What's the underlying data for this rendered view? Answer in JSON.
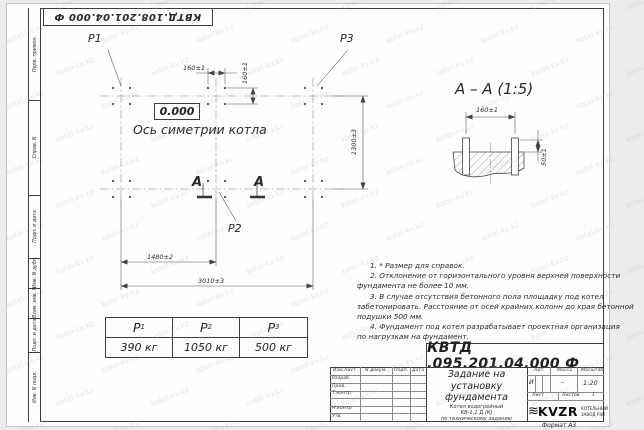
{
  "stamp_top": "КВТД.108.201.04.000 Ф",
  "side_labels": [
    "Перв. примен.",
    "Справ. N",
    "Подп. и дата",
    "Инв. N дубл.",
    "Взам. инв. N",
    "Подп. и дата",
    "Инв. N подл."
  ],
  "plan": {
    "elevation": "0.000",
    "axis_label": "Ось симетрии котла",
    "p1": "P1",
    "p2": "P2",
    "p3": "P3",
    "section_letter": "А",
    "dims": {
      "h160": "160±1",
      "v160": "160±1",
      "right": "1300±3",
      "bottom1": "1480±2",
      "bottom2": "3010±3"
    }
  },
  "section": {
    "title": "А – А (1:5)",
    "dim_width": "160±1",
    "dim_height": "50±1"
  },
  "notes": [
    "1.  * Размер для справок.",
    "2.  Отклонение от горизонтального уровня верхней поверхности",
    "фундамента не более 10 мм.",
    "3.  В случае отсутствия бетонного пола площадку под котел",
    "забетонировать. Расстояние от осей крайних колонн до края бетонной",
    "подушки 500 мм.",
    "4.  Фундамент под котел разрабатывает проектная организация",
    "по нагрузкам на фундамент."
  ],
  "loads": {
    "headers": [
      {
        "base": "P",
        "sub": "1"
      },
      {
        "base": "P",
        "sub": "2"
      },
      {
        "base": "P",
        "sub": "3"
      }
    ],
    "values": [
      "390 кг",
      "1050 кг",
      "500 кг"
    ]
  },
  "designation": "КВТД .095.201.04.000  Ф",
  "title_block": {
    "header_cols": [
      "Изм.Лист",
      "N докум.",
      "Подп.",
      "Дата"
    ],
    "rows": [
      "Разраб.",
      "Пров.",
      "Т.контр.",
      "Н.контр.",
      "Утв."
    ],
    "title_lines": [
      "Задание на",
      "установку",
      "фундамента"
    ],
    "subtitle_lines": [
      "Котел водогрейный",
      "КВ-1,1 Д (К)",
      "по техническому заданию"
    ],
    "lit_header": "Лит.",
    "lit_value": "И",
    "mass_header": "Масса",
    "mass_value": "–",
    "scale_header": "Масштаб",
    "scale_value": "1:20",
    "sheet_label": "Лист",
    "sheets_label": "Листов",
    "sheets_value": "1",
    "logo_waves": "≋",
    "logo_text": "KVZR",
    "logo_caption_1": "КОТЕЛЬНЫЙ",
    "logo_caption_2": "ЗАВОД РЭП",
    "format_label": "Формат А3"
  },
  "watermark": "kotel-kv.kz"
}
